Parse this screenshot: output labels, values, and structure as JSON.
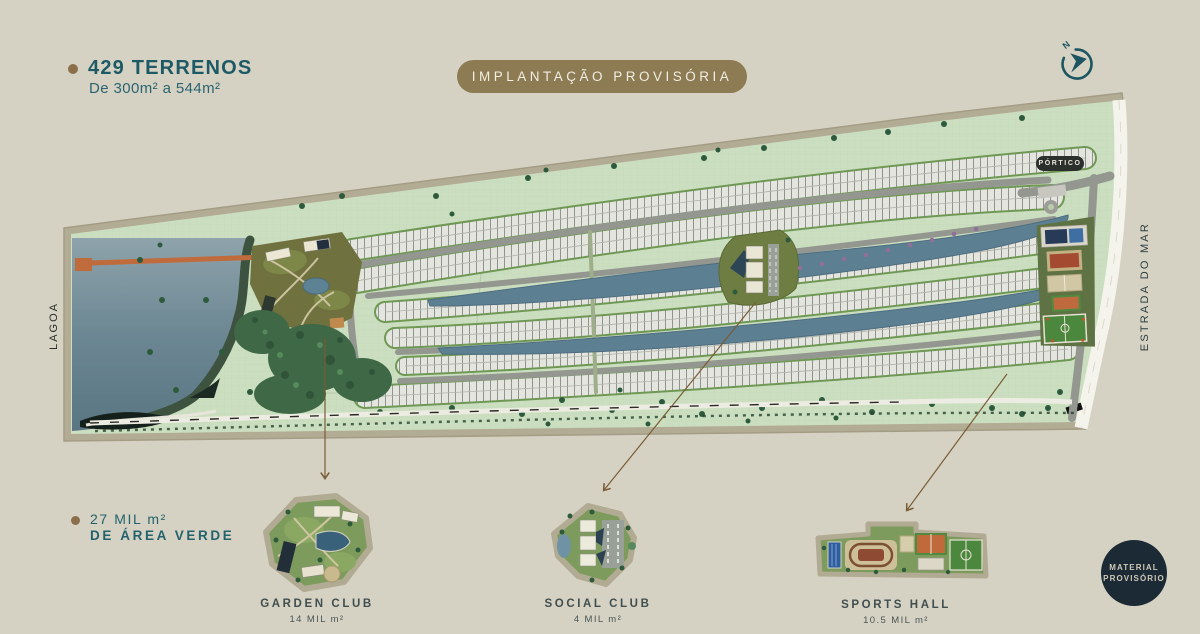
{
  "header": {
    "title": "429 TERRENOS",
    "subtitle": "De 300m² a 544m²"
  },
  "banner": {
    "label": "IMPLANTAÇÃO PROVISÓRIA"
  },
  "compass": {
    "letter": "N"
  },
  "map_labels": {
    "lagoa": "LAGOA",
    "estrada": "ESTRADA DO MAR",
    "portico": "PÓRTICO"
  },
  "green_note": {
    "line1": "27 MIL m²",
    "line2": "DE ÁREA VERDE"
  },
  "callouts": [
    {
      "name": "GARDEN CLUB",
      "area": "14 MIL m²"
    },
    {
      "name": "SOCIAL CLUB",
      "area": "4 MIL m²"
    },
    {
      "name": "SPORTS HALL",
      "area": "10.5 MIL m²"
    }
  ],
  "stamp": {
    "line1": "MATERIAL",
    "line2": "PROVISÓRIO"
  },
  "colors": {
    "background": "#d5d2c3",
    "accent_teal": "#1e5a66",
    "banner_gold": "#8c7b53",
    "bullet_brown": "#8a6f4a",
    "stamp_navy": "#1c2a35",
    "map_green": "#cbdfc0",
    "water_blue": "#5d7f92",
    "border_tan": "#b3ac94",
    "pier_orange": "#c06b3c"
  }
}
